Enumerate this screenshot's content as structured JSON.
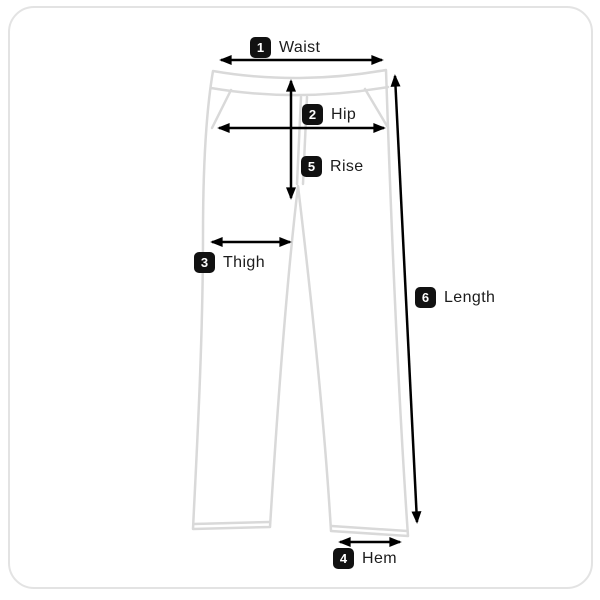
{
  "diagram": {
    "type": "size-guide-measurement-diagram",
    "garment": "pants-front-outline",
    "colors": {
      "background": "#ffffff",
      "card_border": "#e3e3e3",
      "garment_outline": "#d9d9d9",
      "arrow": "#000000",
      "badge_bg": "#111111",
      "badge_text": "#ffffff",
      "label_text": "#1c1c1c"
    },
    "measurements": [
      {
        "number": "1",
        "label": "Waist"
      },
      {
        "number": "2",
        "label": "Hip"
      },
      {
        "number": "3",
        "label": "Thigh"
      },
      {
        "number": "4",
        "label": "Hem"
      },
      {
        "number": "5",
        "label": "Rise"
      },
      {
        "number": "6",
        "label": "Length"
      }
    ]
  }
}
